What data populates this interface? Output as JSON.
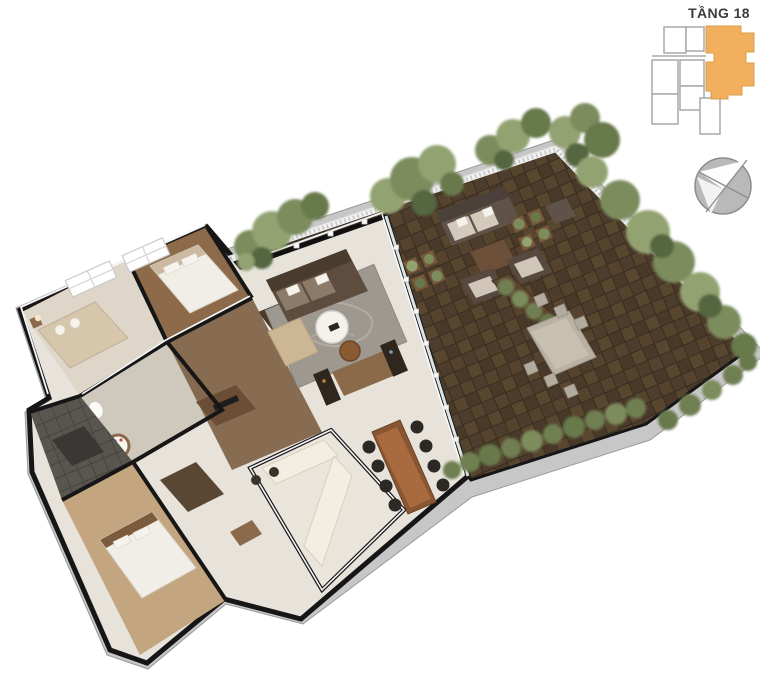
{
  "header": {
    "floor_label": "TẦNG 18"
  },
  "keyplan": {
    "highlight_color": "#F2B05E",
    "outline_color": "#A8A8A8",
    "background": "#FFFFFF"
  },
  "compass": {
    "body_color": "#B9B9B9",
    "outline_color": "#8D8D8D",
    "needle_color": "#FDFDFD"
  },
  "palette": {
    "fascia": "#C7C7C7",
    "wall_cut": "#161616",
    "interior_floor": "#E7E3DB",
    "deck_wood": "#4D3D2D",
    "deck_wood_light": "#58462F",
    "corridor_wood": "#7C5E41",
    "bedroom_wood": "#8D6A49",
    "master_floor": "#C3A67F",
    "railing": "#F0F0F0",
    "foliage": "#7C8C5D",
    "accent_wood": "#8A5531",
    "sofa_brown": "#5E4C3E",
    "bed_linen": "#F1EEE7"
  },
  "floorplan": {
    "regions": [
      "terrace",
      "covered-balcony",
      "living-room",
      "dining-room",
      "kitchen",
      "bedroom-1",
      "bedroom-2",
      "master-bedroom",
      "bathroom",
      "loggia"
    ]
  }
}
